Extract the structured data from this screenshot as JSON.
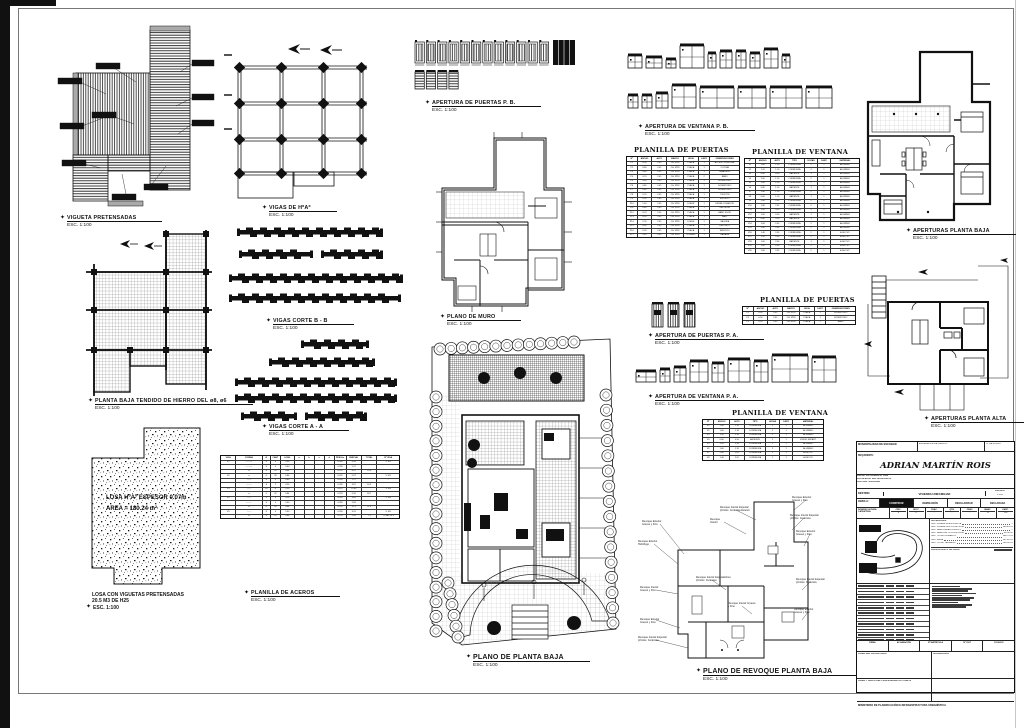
{
  "sheet": {
    "type": "architectural-working-drawing",
    "bg": "#ffffff",
    "ink": "#1a1a1a"
  },
  "captions": {
    "vigueta": {
      "title": "VIGUETA PRETENSADAS",
      "scale": "ESC. 1:100"
    },
    "vigas_hoao": {
      "title": "VIGAS DE HºAº",
      "scale": "ESC. 1:100"
    },
    "puertas_pb": {
      "title": "APERTURA DE PUERTAS P. B.",
      "scale": "ESC. 1:100"
    },
    "ventana_pb": {
      "title": "APERTURA DE VENTANA P. B.",
      "scale": "ESC. 1:100"
    },
    "plano_muro": {
      "title": "PLANO DE MURO",
      "scale": "ESC. 1:100"
    },
    "corte_bb": {
      "title": "VIGAS CORTE B - B",
      "scale": "ESC. 1:100"
    },
    "corte_aa": {
      "title": "VIGAS CORTE A - A",
      "scale": "ESC. 1:100"
    },
    "tendido": {
      "title": "PLANTA BAJA TENDIDO DE HIERRO DEL ø8, ø6",
      "scale": "ESC. 1:100"
    },
    "planta_baja": {
      "title": "PLANO DE PLANTA BAJA",
      "scale": "ESC. 1:100"
    },
    "losa": {
      "title": "LOSA CON VIGUETAS PRETENSADAS",
      "line2": "20.5 M3 DE H25",
      "scale": "ESC. 1:100"
    },
    "aceros": {
      "title": "PLANILLA DE ACEROS",
      "scale": "ESC. 1:100"
    },
    "puertas_pa": {
      "title": "APERTURA DE PUERTAS P. A.",
      "scale": "ESC. 1:100"
    },
    "ventana_pa": {
      "title": "APERTURA DE VENTANA P. A.",
      "scale": "ESC. 1:100"
    },
    "aperturas_pb": {
      "title": "APERTURAS PLANTA BAJA",
      "scale": "ESC. 1:100"
    },
    "aperturas_pa": {
      "title": "APERTURAS PLANTA ALTA",
      "scale": "ESC. 1:100"
    },
    "revoque": {
      "title": "PLANO DE REVOQUE PLANTA BAJA",
      "scale": "ESC. 1:100"
    }
  },
  "losa_labels": {
    "l1": "LOSA HºAº ESPESOR 0.07m",
    "l2": "AREA = 180.24 m²"
  },
  "tables": {
    "planilla_puertas_pb": {
      "title": "PLANILLA DE PUERTAS",
      "group_headers": [
        "Nº",
        "MEDIDAS",
        "ESPECIFICACIONES",
        "OBSERVACIONES"
      ],
      "headers": [
        "Nº",
        "ANCHO",
        "ALTO",
        "MARCO",
        "HOJA",
        "CANT.",
        "OBSERVACIONES"
      ],
      "cols": [
        9,
        13,
        13,
        15,
        13,
        10,
        27
      ],
      "font": 2.1,
      "rows": [
        [
          "P1",
          "0.90",
          "2.05",
          "CH. Nº18",
          "PLACA",
          "1",
          "ACCESO PRINCIPAL"
        ],
        [
          "P2",
          "0.80",
          "2.05",
          "CH. Nº18",
          "PLACA",
          "1",
          "COCINA"
        ],
        [
          "P3",
          "0.80",
          "2.05",
          "CH. Nº18",
          "PLACA",
          "1",
          "LAVADERO"
        ],
        [
          "P4",
          "0.70",
          "2.05",
          "CH. Nº18",
          "PLACA",
          "2",
          "BAÑO"
        ],
        [
          "P5",
          "0.80",
          "2.05",
          "CH. Nº18",
          "PLACA",
          "1",
          "DORMITORIO"
        ],
        [
          "P6",
          "0.80",
          "2.05",
          "CH. Nº18",
          "PLACA",
          "1",
          "DORMITORIO"
        ],
        [
          "P7",
          "0.80",
          "2.05",
          "CH. Nº18",
          "PLACA",
          "1",
          "DORMITORIO"
        ],
        [
          "P8",
          "0.70",
          "2.05",
          "CH. Nº18",
          "PLACA",
          "1",
          "TOILETTE"
        ],
        [
          "P9",
          "0.90",
          "2.05",
          "CH. Nº18",
          "PLACA",
          "1",
          "ESTUDIO"
        ],
        [
          "P10",
          "1.60",
          "2.05",
          "CH. Nº18",
          "DOBLE",
          "1",
          "ESTAR-COMEDOR"
        ],
        [
          "P11",
          "0.80",
          "2.05",
          "CH. Nº18",
          "PLACA",
          "1",
          "VESTIDOR"
        ],
        [
          "P12",
          "0.70",
          "2.05",
          "CH. Nº18",
          "PLACA",
          "1",
          "BAÑO SUITE"
        ],
        [
          "P13",
          "0.90",
          "2.05",
          "CH. Nº18",
          "PLACA",
          "1",
          "HALL"
        ],
        [
          "P14",
          "1.20",
          "2.05",
          "CH. Nº18",
          "DOBLE",
          "1",
          "GALERIA"
        ],
        [
          "P15",
          "0.80",
          "2.05",
          "CH. Nº18",
          "PLACA",
          "1",
          "DEPOSITO"
        ],
        [
          "P16",
          "0.90",
          "2.05",
          "CH. Nº18",
          "PLACA",
          "1",
          "SERVICIO"
        ],
        [
          "P17",
          "2.40",
          "2.05",
          "CH. Nº18",
          "CORRED.",
          "1",
          "GARAGE"
        ]
      ]
    },
    "planilla_ventana_pb": {
      "title": "PLANILLA DE VENTANA",
      "group_headers": [
        "Nº",
        "MEDIDAS",
        "ESPECIFICACIONES",
        "MATERIAL"
      ],
      "headers": [
        "Nº",
        "ANCHO",
        "ALTO",
        "TIPO",
        "HOJAS",
        "CANT.",
        "MATERIAL"
      ],
      "cols": [
        9,
        13,
        12,
        18,
        11,
        11,
        26
      ],
      "font": 2.1,
      "rows": [
        [
          "V1",
          "1.60",
          "1.10",
          "CORREDIZA",
          "2",
          "1",
          "ALUMINIO"
        ],
        [
          "V2",
          "1.20",
          "1.10",
          "CORREDIZA",
          "2",
          "1",
          "ALUMINIO"
        ],
        [
          "V3",
          "0.60",
          "0.50",
          "BATIENTE",
          "1",
          "1",
          "ALUMINIO"
        ],
        [
          "V4",
          "2.00",
          "1.10",
          "CORREDIZA",
          "2",
          "1",
          "ALUMINIO"
        ],
        [
          "V5",
          "1.00",
          "1.10",
          "CORREDIZA",
          "2",
          "1",
          "ALUMINIO"
        ],
        [
          "V6",
          "0.80",
          "1.10",
          "BATIENTE",
          "1",
          "1",
          "ALUMINIO"
        ],
        [
          "V7",
          "1.40",
          "1.10",
          "CORREDIZA",
          "2",
          "1",
          "ALUMINIO"
        ],
        [
          "V8",
          "0.60",
          "1.10",
          "BATIENTE",
          "1",
          "1",
          "ALUMINIO"
        ],
        [
          "V9",
          "2.40",
          "2.05",
          "CORREDIZA",
          "2",
          "1",
          "ALUMINIO"
        ],
        [
          "V10",
          "1.80",
          "2.05",
          "CORREDIZA",
          "2",
          "1",
          "ALUMINIO"
        ],
        [
          "V11",
          "1.20",
          "0.50",
          "CORREDIZA",
          "2",
          "1",
          "ALUMINIO"
        ],
        [
          "V12",
          "1.00",
          "0.50",
          "BATIENTE",
          "1",
          "1",
          "ALUMINIO"
        ],
        [
          "V13",
          "0.80",
          "0.50",
          "BATIENTE",
          "1",
          "1",
          "ALUMINIO"
        ],
        [
          "V14",
          "1.60",
          "2.05",
          "CORREDIZA",
          "2",
          "1",
          "ALUMINIO"
        ],
        [
          "V15",
          "2.00",
          "2.05",
          "CORREDIZA",
          "2",
          "1",
          "ALUMINIO"
        ],
        [
          "V16",
          "1.40",
          "2.05",
          "CORREDIZA",
          "2",
          "1",
          "A DE PVC"
        ],
        [
          "V17",
          "1.20",
          "2.05",
          "CORREDIZA",
          "2",
          "1",
          "A DE PVC"
        ],
        [
          "V18",
          "1.00",
          "2.05",
          "BATIENTE",
          "1",
          "1",
          "A DE PVC"
        ],
        [
          "V19",
          "1.60",
          "2.05",
          "CORREDIZA",
          "2",
          "1",
          "A DE PVC"
        ],
        [
          "V20",
          "1.80",
          "2.05",
          "CORREDIZA",
          "2",
          "1",
          "A DE PVC"
        ]
      ]
    },
    "planilla_puertas_pa": {
      "title": "PLANILLA DE PUERTAS",
      "group_headers": [
        "Nº",
        "MEDIDAS",
        "ESPECIFICACIONES",
        "OBSERVACIONES"
      ],
      "headers": [
        "Nº",
        "ANCHO",
        "ALTO",
        "MARCO",
        "HOJA",
        "CANT.",
        "OBSERVACIONES"
      ],
      "cols": [
        9,
        13,
        13,
        15,
        13,
        10,
        27
      ],
      "font": 2.1,
      "rows": [
        [
          "P1",
          "0.90",
          "2.05",
          "CH. Nº18",
          "PLACA",
          "1",
          "DORMITORIO"
        ],
        [
          "P2",
          "0.90",
          "2.05",
          "CH. Nº18",
          "PLACA",
          "1",
          "DORMITORIO"
        ],
        [
          "P3",
          "0.90",
          "2.05",
          "CH. Nº18",
          "PLACA",
          "1",
          "BAÑO"
        ]
      ]
    },
    "planilla_ventana_pa": {
      "title": "PLANILLA DE VENTANA",
      "group_headers": [
        "Nº",
        "MEDIDAS",
        "ESPECIFICACIONES",
        "MATERIAL"
      ],
      "headers": [
        "Nº",
        "ANCHO",
        "ALTO",
        "TIPO",
        "HOJAS",
        "CANT.",
        "MATERIAL"
      ],
      "cols": [
        9,
        13,
        12,
        18,
        11,
        11,
        26
      ],
      "font": 2.1,
      "rows": [
        [
          "V1",
          "1.60",
          "1.10",
          "CORREDIZA",
          "2",
          "1",
          "ALUMINIO"
        ],
        [
          "V2",
          "1.60",
          "1.10",
          "CORREDIZA",
          "2",
          "1",
          "ALUMINIO"
        ],
        [
          "V3",
          "1.20",
          "1.10",
          "CORREDIZA",
          "2",
          "1",
          "ALUMINIO"
        ],
        [
          "V4",
          "0.60",
          "0.50",
          "BATIENTE",
          "1",
          "1",
          "VIDRIO REPART."
        ],
        [
          "V5",
          "1.20",
          "1.10",
          "CORREDIZA",
          "2",
          "1",
          "ALUMINIO"
        ],
        [
          "V6",
          "1.00",
          "1.10",
          "CORREDIZA",
          "2",
          "1",
          "ALUMINIO"
        ],
        [
          "V7",
          "2.00",
          "2.05",
          "CORREDIZA",
          "2",
          "1",
          "A DE PVC"
        ],
        [
          "V8",
          "1.40",
          "2.05",
          "CORREDIZA",
          "2",
          "1",
          "A DE PVC"
        ]
      ]
    },
    "planilla_aceros": {
      "title": "PLANILLA DE ACEROS",
      "group_headers": [
        "VIGA",
        "FORMA",
        "DIMENSIONES",
        "PESOS"
      ],
      "headers": [
        "VIGA",
        "FORMA",
        "Ø",
        "CANT",
        "LONG",
        "a",
        "b",
        "c",
        "d",
        "PESO/m",
        "PARCIAL",
        "TOTAL",
        "Nº VIGA"
      ],
      "cols": [
        8,
        14,
        4,
        5,
        7,
        5,
        5,
        5,
        5,
        6,
        8,
        8,
        12
      ],
      "font": 2.1,
      "rows": [
        [
          "V1",
          "⌐——⌐",
          "8",
          "4",
          "3.90",
          "",
          "",
          "",
          "",
          "0.395",
          "6.16",
          "",
          "V 101"
        ],
        [
          "",
          "⌐——⌐",
          "8",
          "4",
          "3.40",
          "",
          "",
          "",
          "",
          "0.395",
          "5.37",
          "",
          ".."
        ],
        [
          "",
          "▭",
          "6",
          "24",
          "0.84",
          "",
          "",
          "",
          "",
          "0.222",
          "4.47",
          "15.9",
          ""
        ],
        [
          "V2",
          "▭",
          "6",
          "28",
          "0.84",
          "",
          "",
          "",
          "",
          "0.222",
          "5.22",
          "",
          "V 102"
        ],
        [
          "",
          "——",
          "8",
          "4",
          "4.60",
          "",
          "",
          "",
          "",
          "0.395",
          "7.27",
          "",
          "..."
        ],
        [
          "",
          "⌐——",
          "8",
          "2",
          "4.90",
          "",
          "",
          "",
          "",
          "0.395",
          "3.87",
          "16.3",
          ""
        ],
        [
          "V3",
          "——",
          "10",
          "4",
          "5.20",
          "",
          "",
          "",
          "",
          "0.617",
          "12.83",
          "",
          "V 103"
        ],
        [
          "",
          "▭",
          "6",
          "32",
          "0.84",
          "",
          "",
          "",
          "",
          "0.222",
          "5.96",
          "18.7",
          ""
        ],
        [
          "V4",
          "——",
          "8",
          "4",
          "3.10",
          "",
          "",
          "",
          "",
          "0.395",
          "4.89",
          "",
          "V 104"
        ],
        [
          "",
          "⌐——",
          "8",
          "2",
          "3.40",
          "",
          "",
          "",
          "",
          "0.395",
          "2.68",
          "",
          "..."
        ],
        [
          "",
          "▭",
          "6",
          "20",
          "0.84",
          "",
          "",
          "",
          "",
          "0.222",
          "3.73",
          "11.3",
          ""
        ],
        [
          "V5",
          "——",
          "8",
          "4",
          "2.60",
          "",
          "",
          "",
          "",
          "0.395",
          "4.10",
          "",
          "V 105"
        ],
        [
          "",
          "▭",
          "6",
          "16",
          "0.84",
          "",
          "",
          "",
          "",
          "0.222",
          "2.98",
          "7.1",
          "TOTAL 69.3"
        ]
      ]
    }
  },
  "revoque_annotations": [
    {
      "x": 6,
      "y": 30,
      "l1": "Revoque Exterior",
      "l2": "Grueso y Fino"
    },
    {
      "x": 2,
      "y": 50,
      "l1": "Revoque Exterior",
      "l2": "Hidrófugo"
    },
    {
      "x": 4,
      "y": 96,
      "l1": "Revoque Interior",
      "l2": "Grueso y Fino"
    },
    {
      "x": 4,
      "y": 128,
      "l1": "Revoque Exterior",
      "l2": "Grueso y Fino"
    },
    {
      "x": 2,
      "y": 146,
      "l1": "Revoque Interior Especial",
      "l2": "p/Coloc. Cerámica"
    },
    {
      "x": 84,
      "y": 16,
      "l1": "Revoque Interior Especial",
      "l2": "p/Coloc. Cerámica Exterior"
    },
    {
      "x": 74,
      "y": 28,
      "l1": "Revoque",
      "l2": "Interior"
    },
    {
      "x": 156,
      "y": 6,
      "l1": "Revoque Exterior",
      "l2": "Grueso y Fino"
    },
    {
      "x": 154,
      "y": 24,
      "l1": "Revoque Interior Especial",
      "l2": "p/Coloc. Cerámica"
    },
    {
      "x": 160,
      "y": 40,
      "l1": "Revoque Exterior",
      "l2": "Grueso y Fino"
    },
    {
      "x": 160,
      "y": 88,
      "l1": "Revoque Interior Especial",
      "l2": "p/Coloc. Cerámica"
    },
    {
      "x": 158,
      "y": 118,
      "l1": "Revoque Exterior",
      "l2": "Grueso y Fino"
    },
    {
      "x": 60,
      "y": 86,
      "l1": "Revoque Interior Especialísimo",
      "l2": "p/Coloc. Cerámica"
    },
    {
      "x": 92,
      "y": 112,
      "l1": "Revoque Interior Grueso",
      "l2": "y Fino"
    }
  ],
  "titleblock": {
    "municipality": "MUNICIPALIDAD DE ESCOBAR",
    "file_label": "EXPEDIENTE DE OBRA Nº",
    "sheet_label": "Nº DE PLANO",
    "requirente_label": "REQUIRENTE:",
    "owner": "ADRIAN MARTÍN ROIS",
    "address1": "CALLE: LA PRUEBA Nº 1190",
    "address2": "LOCALIDAD: ING. MASCHWITZ",
    "address3": "PARTIDO: ESCOBAR",
    "destino_label": "DESTINO",
    "destino_value": "VIVIENDA UNIFAMILIAR",
    "escala_label": "ESCALA",
    "escala_value": "1:100",
    "obra_label": "OBRA A:",
    "obra_options": [
      "CONSTRUIR",
      "DEMOLICIÓN",
      "REGULARIZAR",
      "DECLARADA"
    ],
    "obra_selected": "CONSTRUIR",
    "nomenclatura_label": "NOMENCLATURA CATASTRAL",
    "nomenclatura_headers": [
      "CIRC.",
      "SECC.",
      "CHAC.",
      "QTA.",
      "FRAC.",
      "MANZ.",
      "PARC."
    ],
    "nomenclatura_values": [
      "V",
      "F",
      "-",
      "-",
      "-",
      "12",
      "22a"
    ],
    "croquis_label": "CROQUIS DE UBICACIÓN",
    "superficies_label": "SUPERFICIES",
    "superficies": [
      {
        "label": "SUP. CUBIERTA EXISTENTE",
        "value": "--"
      },
      {
        "label": "SUP. CUBIERTA A CONSTRUIR",
        "value": "180.24 m²"
      },
      {
        "label": "SUP. SEMICUBIERTA EXIST.",
        "value": "--"
      },
      {
        "label": "SUP. SEMICUB. A CONSTRUIR",
        "value": "12.50 m²"
      },
      {
        "label": "SUP. TOTAL CUBIERTA",
        "value": "192.74 m²"
      },
      {
        "label": "SUP. LIBRE",
        "value": "407.26 m²"
      },
      {
        "label": "SUP. TOTAL TERRENO",
        "value": "600.00 m²"
      }
    ],
    "presupuesto_label": "PRESUPUESTO DE OBRA",
    "firma_headers": [
      "FIRMA",
      "ACLARACIÓN",
      "Nº MATRÍCULA",
      "Nº CUIT",
      "COLEGIO"
    ],
    "propietario_label": "FIRMA DEL PROPIETARIO",
    "proyectista_label": "FIRMA Y SELLO DEL PROFESIONAL ACTUANTE",
    "aprobacion_label": "APROBACIÓN",
    "ministry": "MINISTERIO DE PLANIFICACIÓN E INFRAESTRUCTURA URBANÍSTICA"
  }
}
